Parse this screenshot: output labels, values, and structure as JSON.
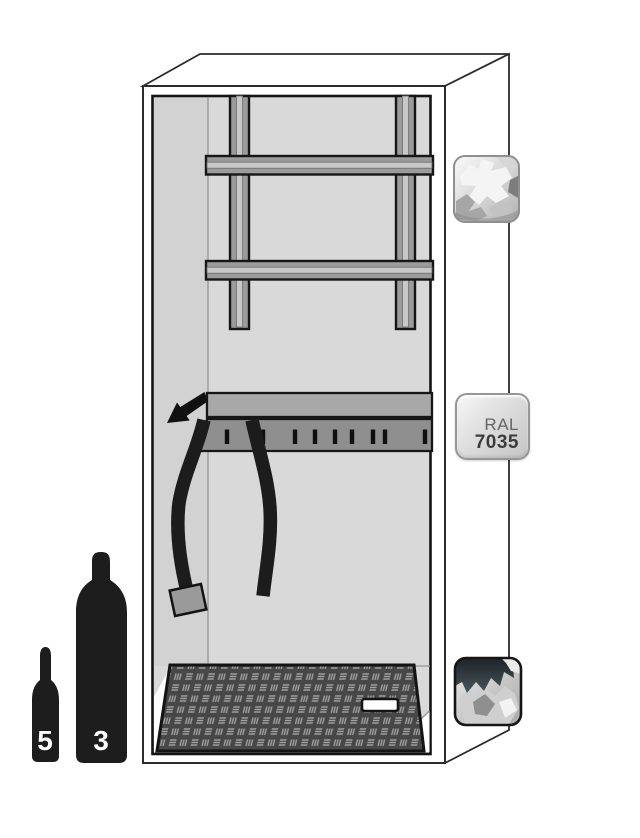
{
  "illustration": {
    "subject": "safety cabinet interior with mounting rails, strap shelf and ramp"
  },
  "color_swatches": {
    "steel_texture_top": {
      "icon": "steel-texture-swatch-icon"
    },
    "ral_badge": {
      "line1": "RAL",
      "line2": "7035"
    },
    "steel_texture_bottom": {
      "icon": "dark-steel-texture-swatch-icon"
    }
  },
  "cylinders": {
    "small": {
      "label": "5"
    },
    "large": {
      "label": "3"
    }
  },
  "colors": {
    "interior_gray": "#d9d9d9",
    "rail_gray": "#9b9b9b",
    "shelf_gray": "#8f8f8f",
    "strap_black": "#1c1c1c",
    "ramp_base": "#474747",
    "ramp_mark": "#a3a3a3",
    "outline": "#2b2b2b",
    "cylinder_black": "#1d1d1d",
    "badge_text": "#3c3c3c",
    "background": "#ffffff"
  }
}
